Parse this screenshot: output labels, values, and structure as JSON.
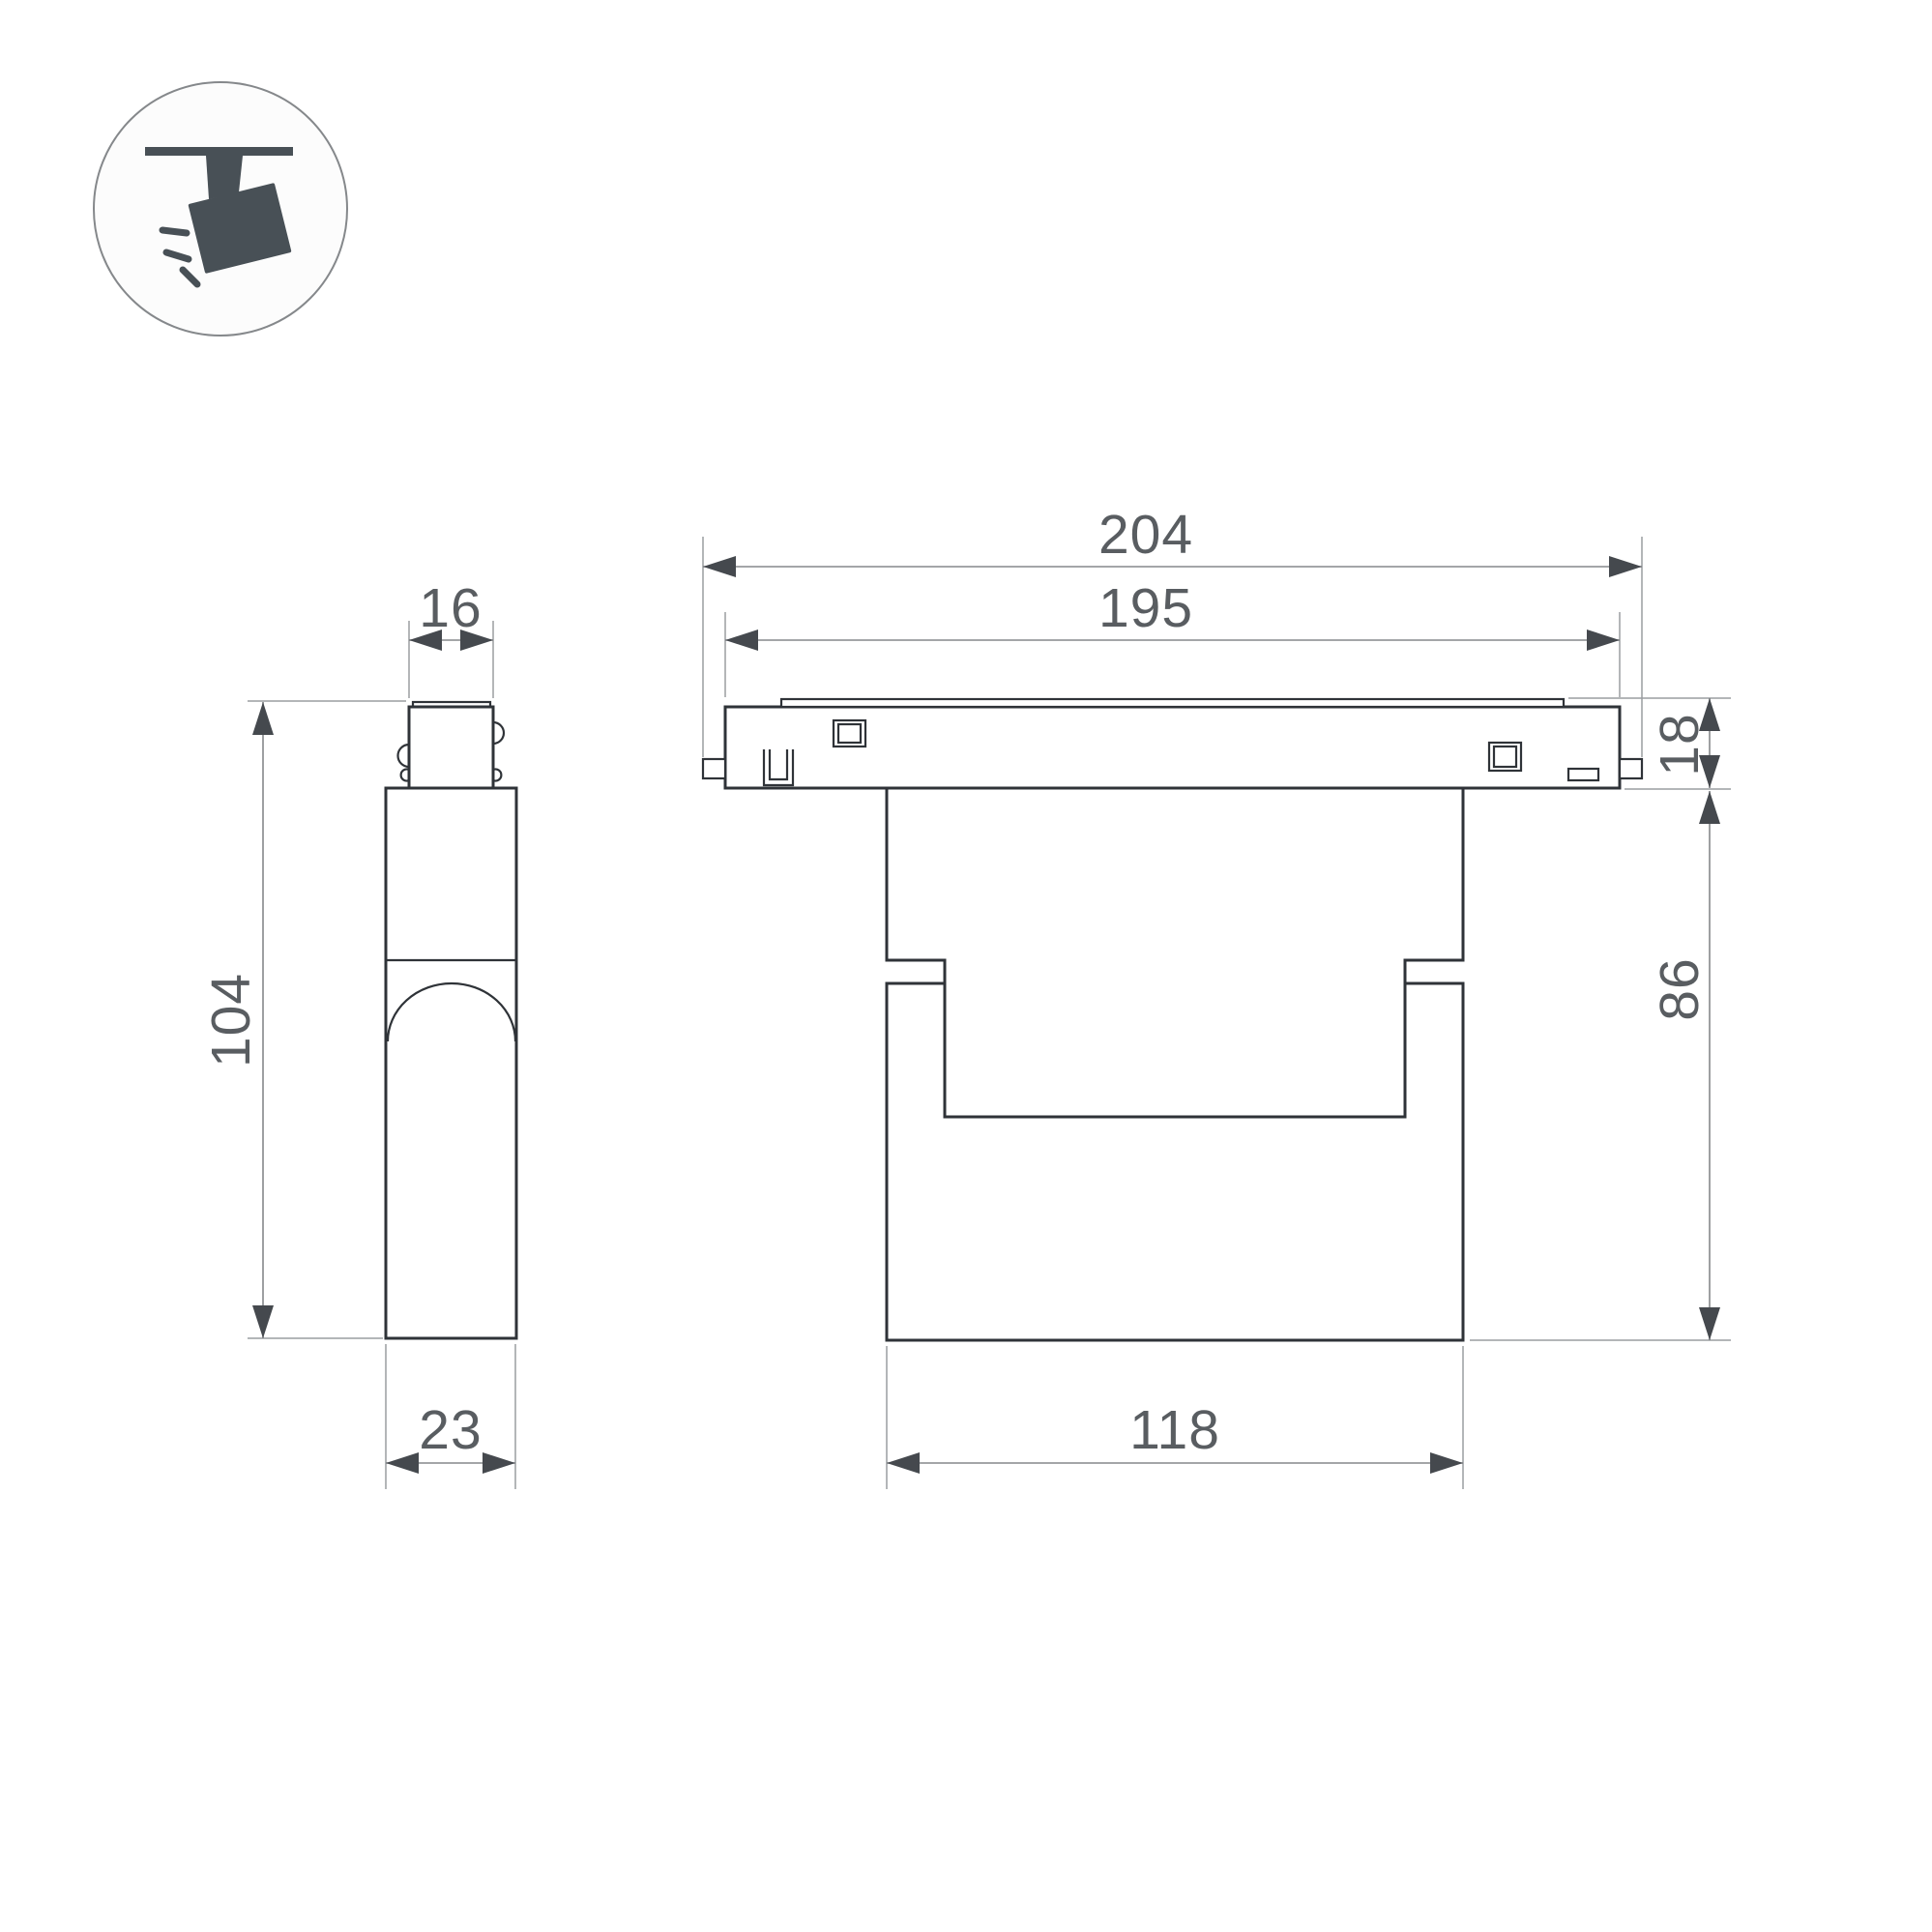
{
  "document": {
    "type": "technical-dimension-drawing",
    "subject": "track-mounted-spotlight-luminaire",
    "views": {
      "side_view_name": "side-view",
      "front_view_name": "front-view"
    }
  },
  "icon": {
    "name": "track-spotlight-icon"
  },
  "dimensions": {
    "side_view": {
      "adapter_width": "16",
      "overall_height": "104",
      "body_depth": "23"
    },
    "front_view": {
      "overall_width": "204",
      "rail_width": "195",
      "rail_height": "18",
      "body_height": "86",
      "body_width": "118"
    }
  },
  "colors": {
    "background": "#ffffff",
    "part_outline": "#2f3338",
    "dimension_line": "#85888b",
    "extension_line": "#9a9da0",
    "arrow_fill": "#45494e",
    "label_text": "#595d61",
    "icon_fill": "#485056",
    "icon_circle_stroke": "#85888b"
  }
}
